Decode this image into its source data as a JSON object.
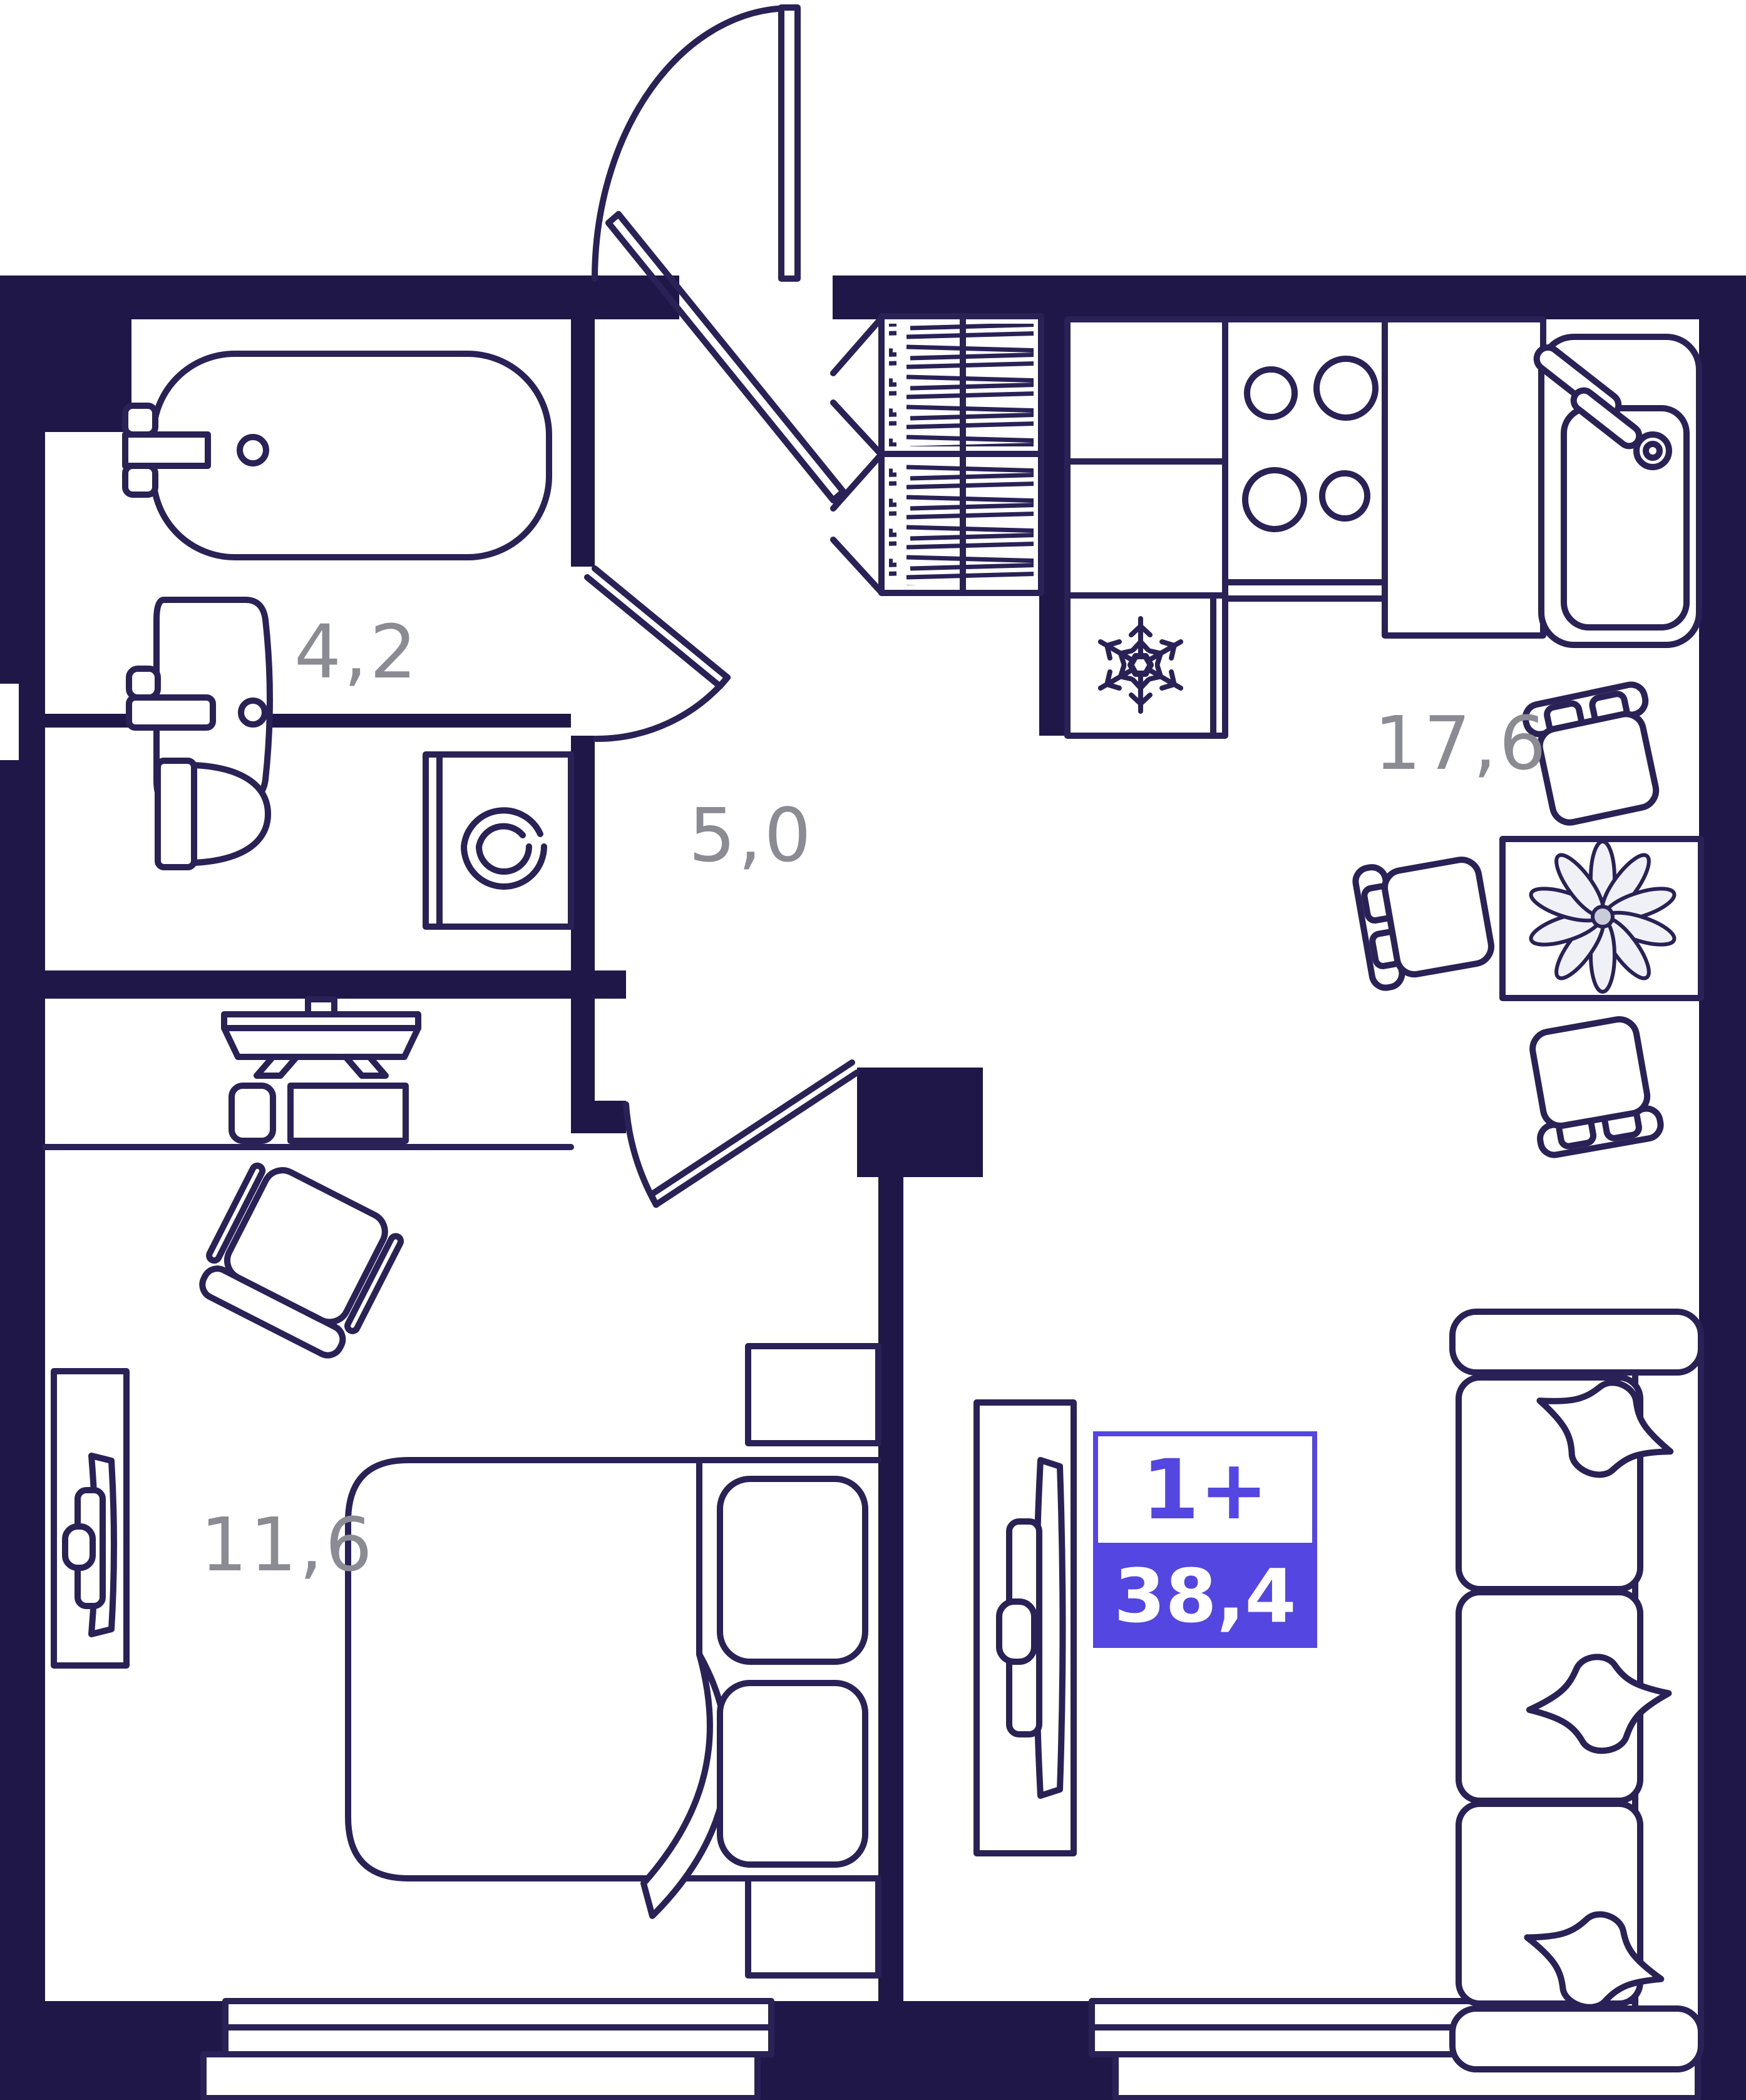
{
  "plan": {
    "title": "1-room apartment floor plan",
    "badge": {
      "type_label": "1+",
      "total_area": "38,4"
    },
    "rooms": [
      {
        "id": "bathroom",
        "area": "4,2"
      },
      {
        "id": "hallway",
        "area": "5,0"
      },
      {
        "id": "kitchen_living",
        "area": "17,6"
      },
      {
        "id": "bedroom",
        "area": "11,6"
      }
    ],
    "colors": {
      "wall": "#1e1747",
      "line": "#2a2157",
      "label": "#8b8b93",
      "accent": "#5447e1",
      "plant_petal": "#f0f0f7",
      "plant_center": "#c9cada"
    }
  }
}
